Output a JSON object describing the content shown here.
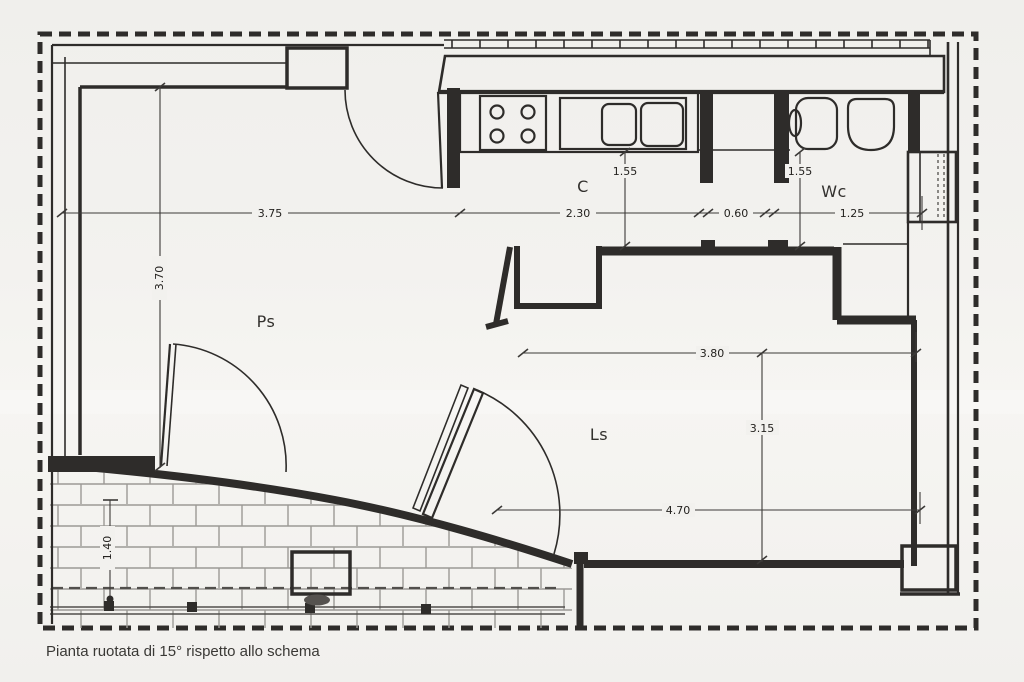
{
  "caption": "Pianta ruotata di 15° rispetto allo schema",
  "rooms": {
    "ps": "Ps",
    "c": "C",
    "wc": "Wc",
    "ls": "Ls"
  },
  "dims": {
    "ps_width": "3.75",
    "kitchen_width": "2.30",
    "hall_width": "0.60",
    "wc_width": "1.25",
    "kitchen_depth": "1.55",
    "wc_depth": "1.55",
    "ps_depth": "3.70",
    "ls_width_top": "3.80",
    "ls_depth": "3.15",
    "ls_width_bottom": "4.70",
    "terrace_depth": "1.40"
  },
  "colors": {
    "paper": "#f2f1ee",
    "ink": "#2e2c2a",
    "ink-soft": "#514f4c",
    "dim": "#3c3a38",
    "brick": "#9b9995"
  }
}
